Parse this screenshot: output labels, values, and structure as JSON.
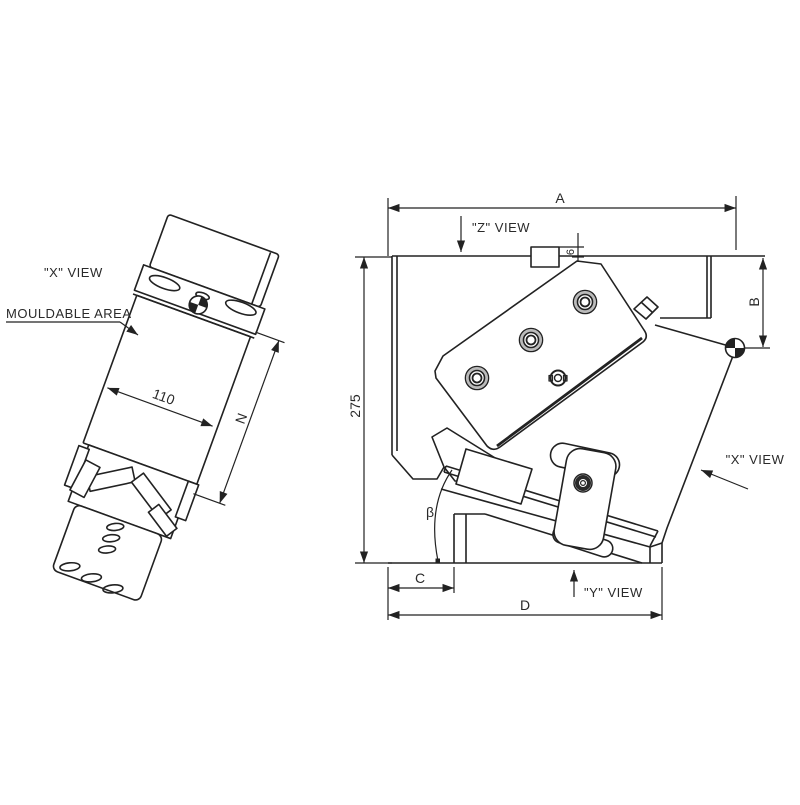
{
  "page": {
    "background": "#ffffff",
    "line_color": "#222222"
  },
  "left_view": {
    "view_label": "\"X\" VIEW",
    "mouldable_area_label": "MOULDABLE AREA",
    "dim_width": "110",
    "dim_length": "N"
  },
  "right_view": {
    "z_view_label": "\"Z\" VIEW",
    "x_view_label": "\"X\" VIEW",
    "y_view_label": "\"Y\" VIEW",
    "dim_overall_width": "A",
    "dim_overall_height": "275",
    "dim_right_height": "B",
    "dim_block_offset": "6",
    "dim_foot_offset": "C",
    "dim_base_width": "D",
    "dim_angle": "β"
  }
}
